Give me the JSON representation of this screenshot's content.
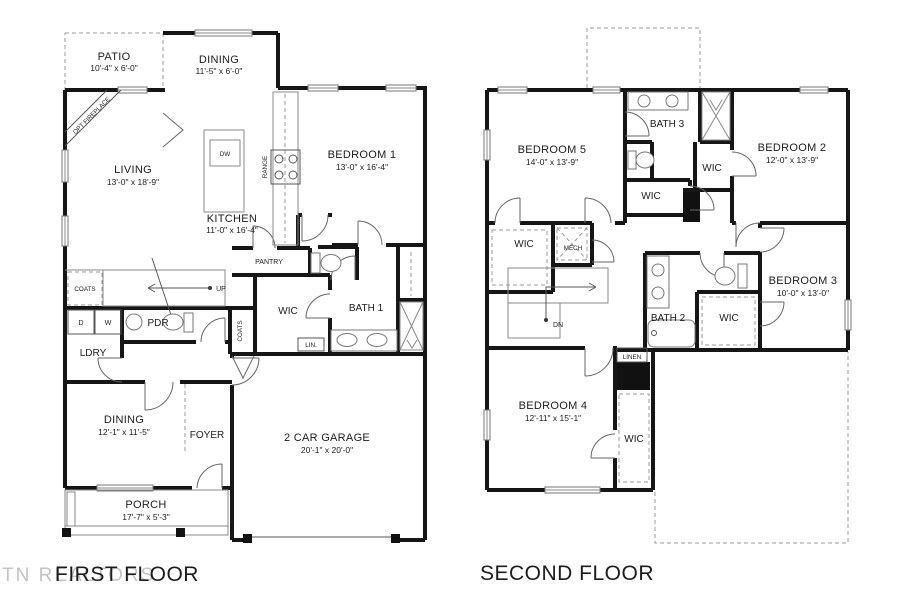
{
  "watermark": "TN REALTORS",
  "ff": {
    "title": "FIRST FLOOR",
    "patio": {
      "name": "PATIO",
      "dims": "10'-4\" x 6'-0\""
    },
    "dining_top": {
      "name": "DINING",
      "dims": "11'-5\" x 6'-0\""
    },
    "living": {
      "name": "LIVING",
      "dims": "13'-0\" x 18'-9\""
    },
    "kitchen": {
      "name": "KITCHEN",
      "dims": "11'-0\" x 16'-4\""
    },
    "bedroom1": {
      "name": "BEDROOM 1",
      "dims": "13'-0\" x 16'-4\""
    },
    "dining_bottom": {
      "name": "DINING",
      "dims": "12'-1\" x 11'-5\""
    },
    "garage": {
      "name": "2 CAR GARAGE",
      "dims": "20'-1\" x 20'-0\""
    },
    "porch": {
      "name": "PORCH",
      "dims": "17'-7\" x 5'-3\""
    },
    "foyer": "FOYER",
    "pantry": "PANTRY",
    "wic": "WIC",
    "bath1": "BATH 1",
    "lin": "LIN.",
    "coats_a": "COATS",
    "coats_b": "COATS",
    "pdr": "PDR",
    "ldry": "LDRY",
    "d": "D",
    "w": "W",
    "up": "UP",
    "dw": "DW",
    "range": "RANGE",
    "fireplace": "OPT FIREPLACE"
  },
  "sf": {
    "title": "SECOND FLOOR",
    "bedroom5": {
      "name": "BEDROOM 5",
      "dims": "14'-0\" x 13'-9\""
    },
    "bedroom2": {
      "name": "BEDROOM 2",
      "dims": "12'-0\" x 13'-9\""
    },
    "bedroom3": {
      "name": "BEDROOM 3",
      "dims": "10'-0\" x 13'-0\""
    },
    "bedroom4": {
      "name": "BEDROOM 4",
      "dims": "12'-11\" x 15'-1\""
    },
    "bath3": "BATH 3",
    "bath2": "BATH 2",
    "wic_hall": "WIC",
    "wic_bed2": "WIC",
    "wic_left": "WIC",
    "wic_bed3": "WIC",
    "wic_bed4": "WIC",
    "mech": "MECH",
    "linen": "LINEN",
    "dn": "DN"
  }
}
